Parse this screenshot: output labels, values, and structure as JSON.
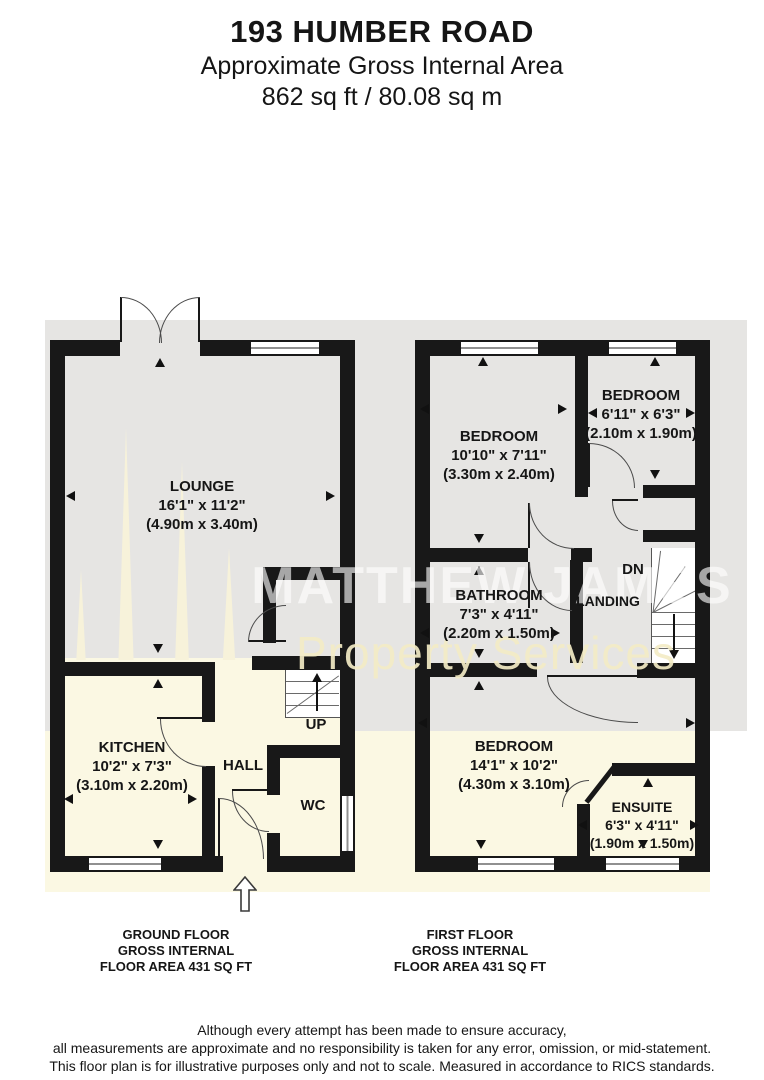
{
  "header": {
    "title": "193 HUMBER ROAD",
    "subtitle": "Approximate Gross Internal Area",
    "area": "862 sq ft / 80.08 sq m"
  },
  "watermark": {
    "line1": "MATTHEW JAMES",
    "line2": "Property Services"
  },
  "ground_floor": {
    "rooms": {
      "lounge": {
        "name": "LOUNGE",
        "dims_ft": "16'1\" x 11'2\"",
        "dims_m": "(4.90m x 3.40m)"
      },
      "kitchen": {
        "name": "KITCHEN",
        "dims_ft": "10'2\" x 7'3\"",
        "dims_m": "(3.10m x 2.20m)"
      },
      "hall": {
        "name": "HALL"
      },
      "wc": {
        "name": "WC"
      },
      "stairs": {
        "label": "UP"
      }
    },
    "caption": [
      "GROUND FLOOR",
      "GROSS INTERNAL",
      "FLOOR AREA 431 SQ FT"
    ]
  },
  "first_floor": {
    "rooms": {
      "bedroom1": {
        "name": "BEDROOM",
        "dims_ft": "10'10\" x 7'11\"",
        "dims_m": "(3.30m x 2.40m)"
      },
      "bedroom2": {
        "name": "BEDROOM",
        "dims_ft": "6'11\" x 6'3\"",
        "dims_m": "(2.10m x 1.90m)"
      },
      "bathroom": {
        "name": "BATHROOM",
        "dims_ft": "7'3\" x 4'11\"",
        "dims_m": "(2.20m x 1.50m)"
      },
      "landing": {
        "name": "LANDING"
      },
      "stairs": {
        "label": "DN"
      },
      "bedroom3": {
        "name": "BEDROOM",
        "dims_ft": "14'1\" x 10'2\"",
        "dims_m": "(4.30m x 3.10m)"
      },
      "ensuite": {
        "name": "ENSUITE",
        "dims_ft": "6'3\" x 4'11\"",
        "dims_m": "(1.90m x 1.50m)"
      }
    },
    "caption": [
      "FIRST FLOOR",
      "GROSS INTERNAL",
      "FLOOR AREA 431 SQ FT"
    ]
  },
  "disclaimer": [
    "Although every attempt has been made to ensure accuracy,",
    "all measurements are approximate and no responsibility is taken for any error, omission, or mid-statement.",
    "This floor plan is for illustrative purposes only and not to scale. Measured in accordance to RICS standards."
  ],
  "colors": {
    "wall": "#181818",
    "floor_gray": "#e6e5e3",
    "floor_cream": "#fbf8e3",
    "watermark_white": "#ffffff",
    "watermark_cream": "#f3ebc6"
  }
}
